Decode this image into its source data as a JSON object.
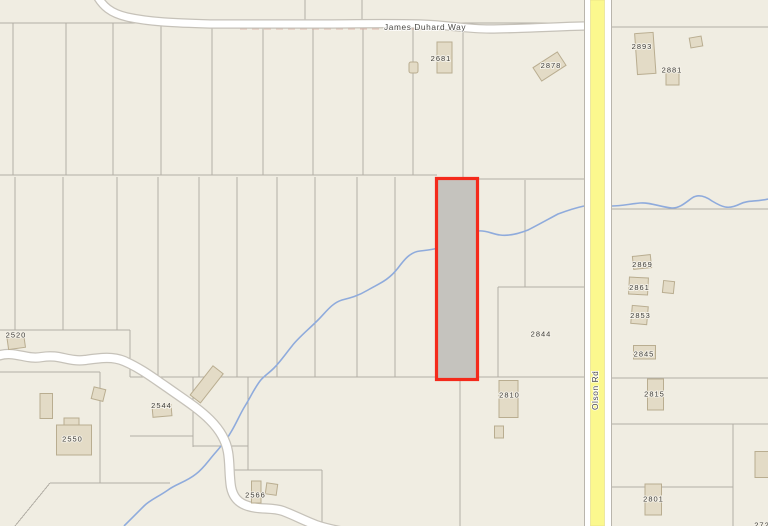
{
  "map": {
    "labels": {
      "james_duhard_way": "James Duhard Way",
      "olson_rd": "Olson Rd",
      "p2681": "2681",
      "p2878": "2878",
      "p2893": "2893",
      "p2881": "2881",
      "p2869": "2869",
      "p2861": "2861",
      "p2853": "2853",
      "p2845": "2845",
      "p2844": "2844",
      "p2810": "2810",
      "p2815": "2815",
      "p2801": "2801",
      "p2520": "2520",
      "p2544": "2544",
      "p2550": "2550",
      "p2566": "2566",
      "partial_bottom_right": "272"
    },
    "selected_parcel": {
      "fill": "#c5c3be",
      "outline": "#f42a1b"
    },
    "colors": {
      "background": "#f0ede2",
      "parcel_line": "#b2aea5",
      "road_fill": "#ffffff",
      "road_casing": "#c6c2b9",
      "olson_road_yellow": "#fbf88e",
      "stream_blue": "#8fabdc",
      "building_fill": "#e3dbc6",
      "building_outline": "#b9ad90",
      "label_text": "#3f3e3a"
    }
  }
}
